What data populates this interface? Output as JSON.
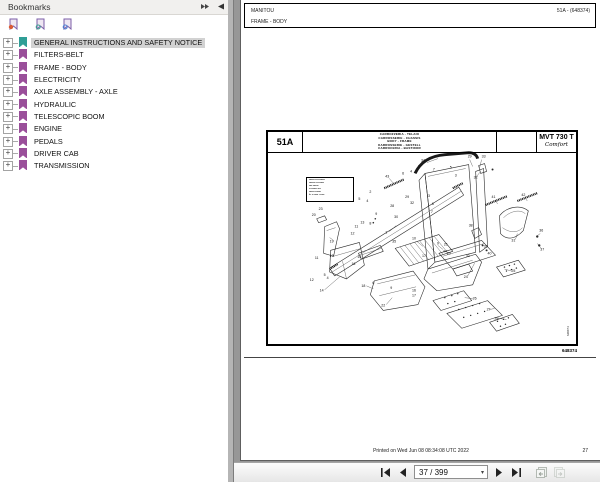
{
  "panel": {
    "title": "Bookmarks",
    "items": [
      {
        "label": "GENERAL INSTRUCTIONS AND SAFETY NOTICE",
        "selected": true
      },
      {
        "label": "FILTERS-BELT",
        "selected": false
      },
      {
        "label": "FRAME - BODY",
        "selected": false
      },
      {
        "label": "ELECTRICITY",
        "selected": false
      },
      {
        "label": "AXLE ASSEMBLY - AXLE",
        "selected": false
      },
      {
        "label": "HYDRAULIC",
        "selected": false
      },
      {
        "label": "TELESCOPIC BOOM",
        "selected": false
      },
      {
        "label": "ENGINE",
        "selected": false
      },
      {
        "label": "PEDALS",
        "selected": false
      },
      {
        "label": "DRIVER CAB",
        "selected": false
      },
      {
        "label": "TRANSMISSION",
        "selected": false
      }
    ],
    "expand_glyph": "+",
    "colors": {
      "ribbon_selected": "#2f9e96",
      "ribbon_default": "#9a4f9a",
      "badge1": "#d95b35",
      "badge2": "#3a9e8f",
      "badge3": "#4a7fd4",
      "selection_bg": "#d2d2d2"
    }
  },
  "document": {
    "header": {
      "brand": "MANITOU",
      "page_ref": "51A - (648374)",
      "section": "FRAME - BODY"
    },
    "plate": {
      "code": "51A",
      "title_lines": [
        "CARROZZERIA - TELAIO",
        "CARROSSERIE - CHASSIS",
        "BODY - FRAME",
        "KARROSSERIE - GESTELL",
        "CARROCERIA - BASTIDOR"
      ],
      "model": "MVT 730 T",
      "model_variant": "Comfort",
      "drawing_number": "648374",
      "note_box_lines": [
        "▪▪▪▪▪▪▪ ▪▪▪ ▪▪▪▪▪▪▪▪",
        "▪▪▪▪▪▪▪▪ ▪▪ ▪▪▪▪▪▪▪",
        "▪▪▪▪ ▪▪▪▪▪▪▪",
        "▪▪ ▪▪▪▪▪▪▪ ▪▪▪▪",
        "▪▪▪▪▪▪▪ ▪▪▪▪▪▪▪",
        "► ▪▪ ▪▪▪▪▪ ▪ ▪▪▪▪▪"
      ],
      "callouts": [
        {
          "n": "34",
          "x": 156,
          "y": 30
        },
        {
          "n": "29",
          "x": 203,
          "y": 26
        },
        {
          "n": "33",
          "x": 217,
          "y": 26
        },
        {
          "n": "32",
          "x": 209,
          "y": 47
        },
        {
          "n": "5",
          "x": 184,
          "y": 37
        },
        {
          "n": "3",
          "x": 189,
          "y": 45
        },
        {
          "n": "7",
          "x": 167,
          "y": 39
        },
        {
          "n": "43",
          "x": 120,
          "y": 46
        },
        {
          "n": "6",
          "x": 136,
          "y": 43
        },
        {
          "n": "4",
          "x": 144,
          "y": 41
        },
        {
          "n": "2",
          "x": 152,
          "y": 36
        },
        {
          "n": "2",
          "x": 103,
          "y": 62
        },
        {
          "n": "5",
          "x": 92,
          "y": 69
        },
        {
          "n": "4",
          "x": 100,
          "y": 71
        },
        {
          "n": "29",
          "x": 140,
          "y": 67
        },
        {
          "n": "28",
          "x": 125,
          "y": 76
        },
        {
          "n": "32",
          "x": 145,
          "y": 73
        },
        {
          "n": "30",
          "x": 129,
          "y": 87
        },
        {
          "n": "9",
          "x": 109,
          "y": 84
        },
        {
          "n": "8",
          "x": 103,
          "y": 94
        },
        {
          "n": "3",
          "x": 162,
          "y": 66
        },
        {
          "n": "6",
          "x": 166,
          "y": 74
        },
        {
          "n": "7",
          "x": 165,
          "y": 82
        },
        {
          "n": "1",
          "x": 119,
          "y": 103
        },
        {
          "n": "23",
          "x": 53,
          "y": 79
        },
        {
          "n": "20",
          "x": 46,
          "y": 85
        },
        {
          "n": "19",
          "x": 64,
          "y": 112
        },
        {
          "n": "13",
          "x": 95,
          "y": 93
        },
        {
          "n": "11",
          "x": 89,
          "y": 97
        },
        {
          "n": "12",
          "x": 85,
          "y": 104
        },
        {
          "n": "10",
          "x": 147,
          "y": 109
        },
        {
          "n": "35",
          "x": 127,
          "y": 112
        },
        {
          "n": "9",
          "x": 171,
          "y": 114
        },
        {
          "n": "44",
          "x": 178,
          "y": 122
        },
        {
          "n": "38",
          "x": 204,
          "y": 96
        },
        {
          "n": "41",
          "x": 227,
          "y": 67
        },
        {
          "n": "42",
          "x": 257,
          "y": 65
        },
        {
          "n": "31",
          "x": 247,
          "y": 111
        },
        {
          "n": "36",
          "x": 275,
          "y": 101
        },
        {
          "n": "37",
          "x": 276,
          "y": 120
        },
        {
          "n": "39",
          "x": 219,
          "y": 117
        },
        {
          "n": "40",
          "x": 223,
          "y": 124
        },
        {
          "n": "32",
          "x": 201,
          "y": 127
        },
        {
          "n": "17",
          "x": 157,
          "y": 127
        },
        {
          "n": "21",
          "x": 179,
          "y": 115
        },
        {
          "n": "20",
          "x": 182,
          "y": 124
        },
        {
          "n": "24",
          "x": 199,
          "y": 148
        },
        {
          "n": "25",
          "x": 247,
          "y": 142
        },
        {
          "n": "11",
          "x": 49,
          "y": 129
        },
        {
          "n": "13",
          "x": 64,
          "y": 127
        },
        {
          "n": "15",
          "x": 92,
          "y": 128
        },
        {
          "n": "16",
          "x": 86,
          "y": 135
        },
        {
          "n": "5",
          "x": 57,
          "y": 146
        },
        {
          "n": "4",
          "x": 60,
          "y": 149
        },
        {
          "n": "12",
          "x": 44,
          "y": 151
        },
        {
          "n": "14",
          "x": 54,
          "y": 162
        },
        {
          "n": "18",
          "x": 96,
          "y": 157
        },
        {
          "n": "6",
          "x": 106,
          "y": 154
        },
        {
          "n": "9",
          "x": 124,
          "y": 159
        },
        {
          "n": "22",
          "x": 116,
          "y": 177
        },
        {
          "n": "16",
          "x": 147,
          "y": 162
        },
        {
          "n": "17",
          "x": 147,
          "y": 167
        },
        {
          "n": "26",
          "x": 208,
          "y": 170
        },
        {
          "n": "27",
          "x": 222,
          "y": 181
        },
        {
          "n": "28",
          "x": 230,
          "y": 190
        }
      ]
    },
    "footer": {
      "printed": "Printed on   Wed Jun 08 08:34:08 UTC 2022",
      "page_number": "27"
    }
  },
  "toolbar": {
    "page_field": "37 / 399"
  }
}
